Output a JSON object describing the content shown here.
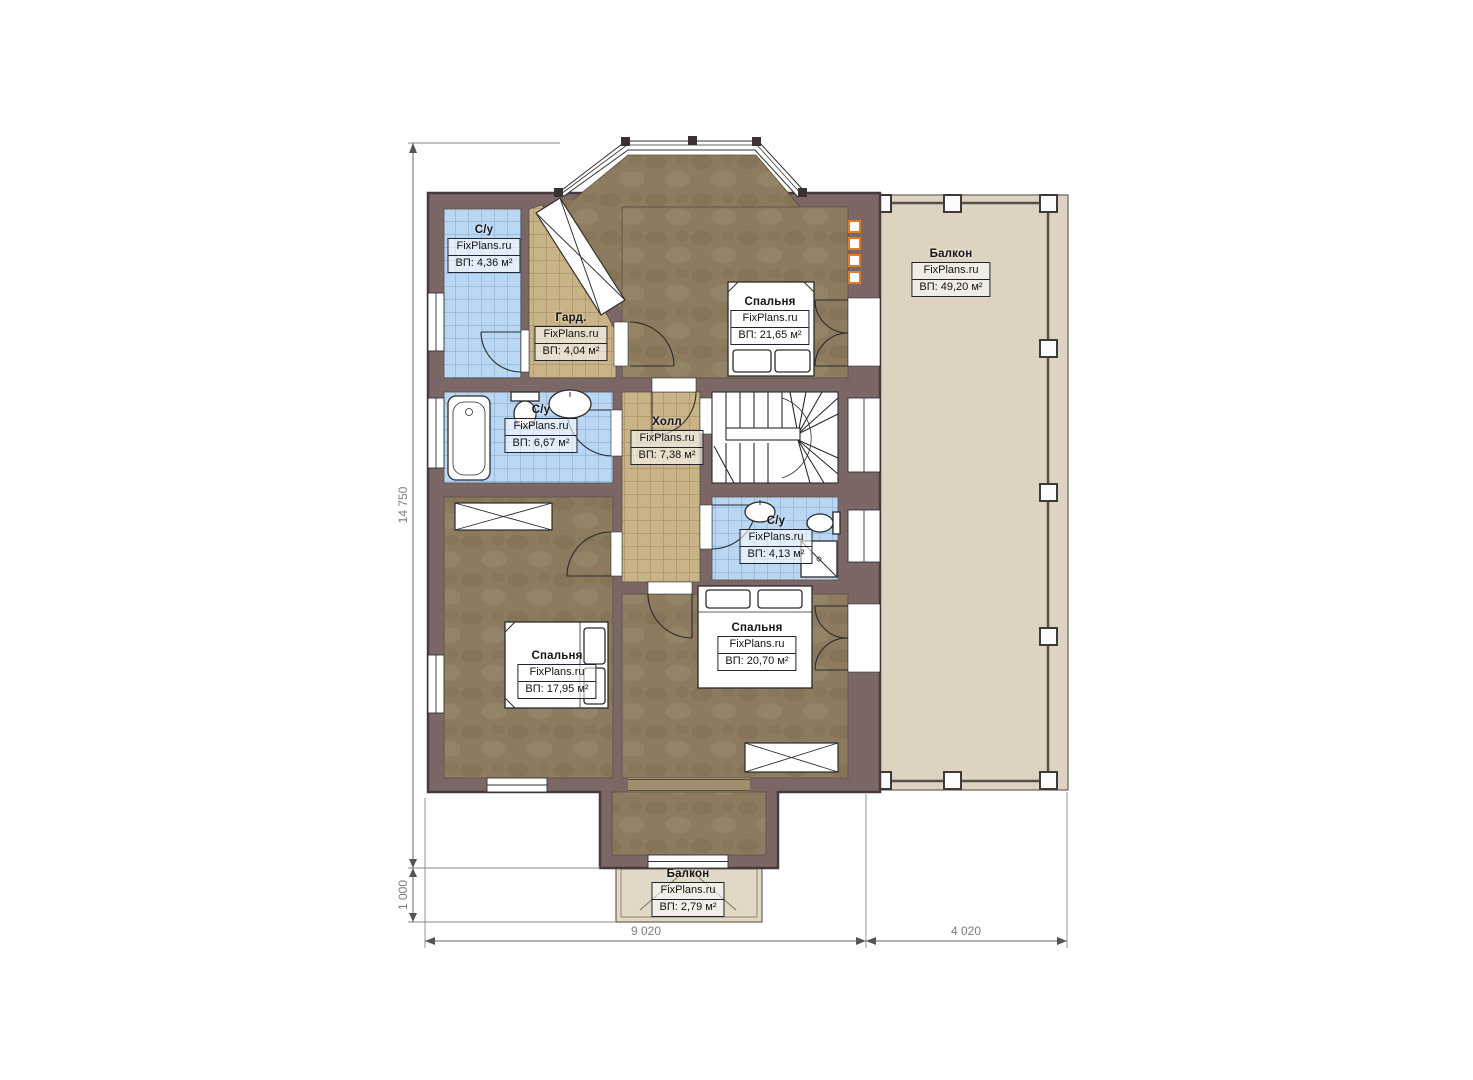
{
  "palette": {
    "wall_fill": "#7c6767",
    "wall_outline": "#463a3a",
    "floor_wood": "#8c7b5e",
    "tile_blue": "#b9d6f2",
    "tile_blue_grid": "#7fa8d0",
    "tile_tan": "#c9b488",
    "tile_tan_grid": "#9f855a",
    "balcony_floor": "#ded3c0",
    "fixture_outline": "#2b2b2b",
    "accent_orange": "#e07b28",
    "dimension_color": "#7e7e7e"
  },
  "rooms": [
    {
      "id": "bathroom-top",
      "name": "С/у",
      "watermark": "FixPlans.ru",
      "area": "ВП: 4,36 м²"
    },
    {
      "id": "wardrobe",
      "name": "Гард.",
      "watermark": "FixPlans.ru",
      "area": "ВП: 4,04 м²"
    },
    {
      "id": "bedroom-top",
      "name": "Спальня",
      "watermark": "FixPlans.ru",
      "area": "ВП: 21,65 м²"
    },
    {
      "id": "balcony-right",
      "name": "Балкон",
      "watermark": "FixPlans.ru",
      "area": "ВП: 49,20 м²"
    },
    {
      "id": "bathroom-middle",
      "name": "С/у",
      "watermark": "FixPlans.ru",
      "area": "ВП: 6,67 м²"
    },
    {
      "id": "hall",
      "name": "Холл",
      "watermark": "FixPlans.ru",
      "area": "ВП: 7,38 м²"
    },
    {
      "id": "bathroom-small",
      "name": "С/у",
      "watermark": "FixPlans.ru",
      "area": "ВП: 4,13 м²"
    },
    {
      "id": "bedroom-left",
      "name": "Спальня",
      "watermark": "FixPlans.ru",
      "area": "ВП: 17,95 м²"
    },
    {
      "id": "bedroom-center",
      "name": "Спальня",
      "watermark": "FixPlans.ru",
      "area": "ВП: 20,70 м²"
    },
    {
      "id": "balcony-bottom",
      "name": "Балкон",
      "watermark": "FixPlans.ru",
      "area": "ВП: 2,79 м²"
    }
  ],
  "dimensions": {
    "height_total": "14 750",
    "balcony_depth": "1 000",
    "width_main": "9 020",
    "width_balcony": "4 020"
  }
}
